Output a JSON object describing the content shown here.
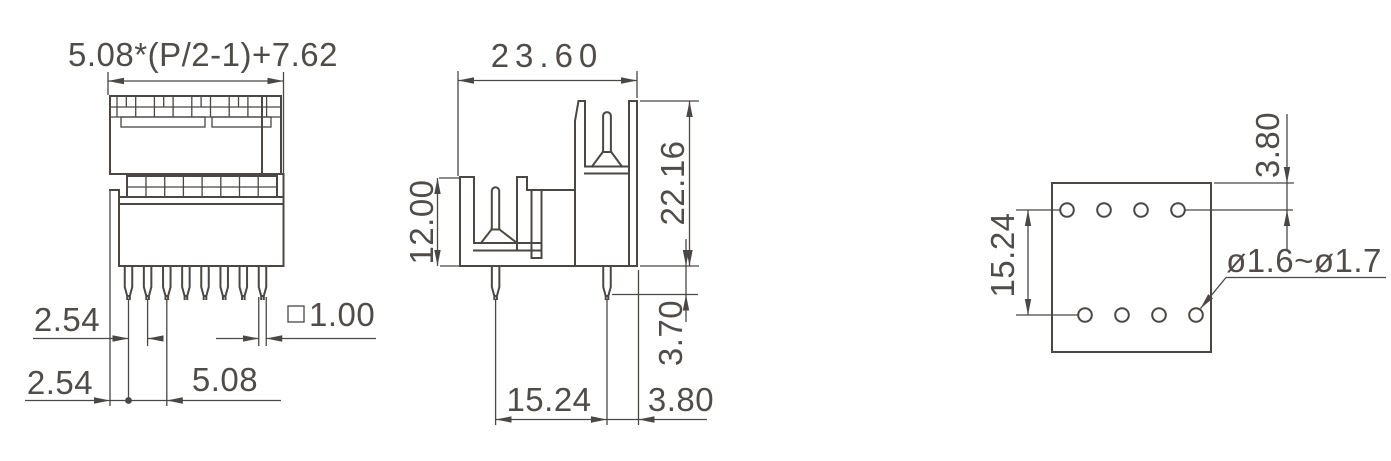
{
  "views": {
    "front": {
      "name": "front-view",
      "pin_count": 8,
      "dims": {
        "overall_width_formula": "5.08*(P/2-1)+7.62",
        "pin_pitch": "2.54",
        "edge_to_first_pin": "2.54",
        "double_pitch": "5.08",
        "pin_square_label": "□1.00",
        "pin_square_value": "1.00"
      }
    },
    "side": {
      "name": "side-view",
      "dims": {
        "depth": "23.60",
        "front_height": "12.00",
        "overall_height": "22.16",
        "pin_protrusion": "3.70",
        "pin_row_spacing": "15.24",
        "pin_to_edge": "3.80"
      }
    },
    "footprint": {
      "name": "pcb-footprint-view",
      "rows": 2,
      "holes_per_row": 4,
      "dims": {
        "row_spacing": "15.24",
        "edge_to_row": "3.80",
        "hole_diameter": "ø1.6~ø1.7"
      }
    }
  },
  "colors": {
    "line": "#4a4744",
    "text": "#4f4c49",
    "background": "#ffffff"
  }
}
